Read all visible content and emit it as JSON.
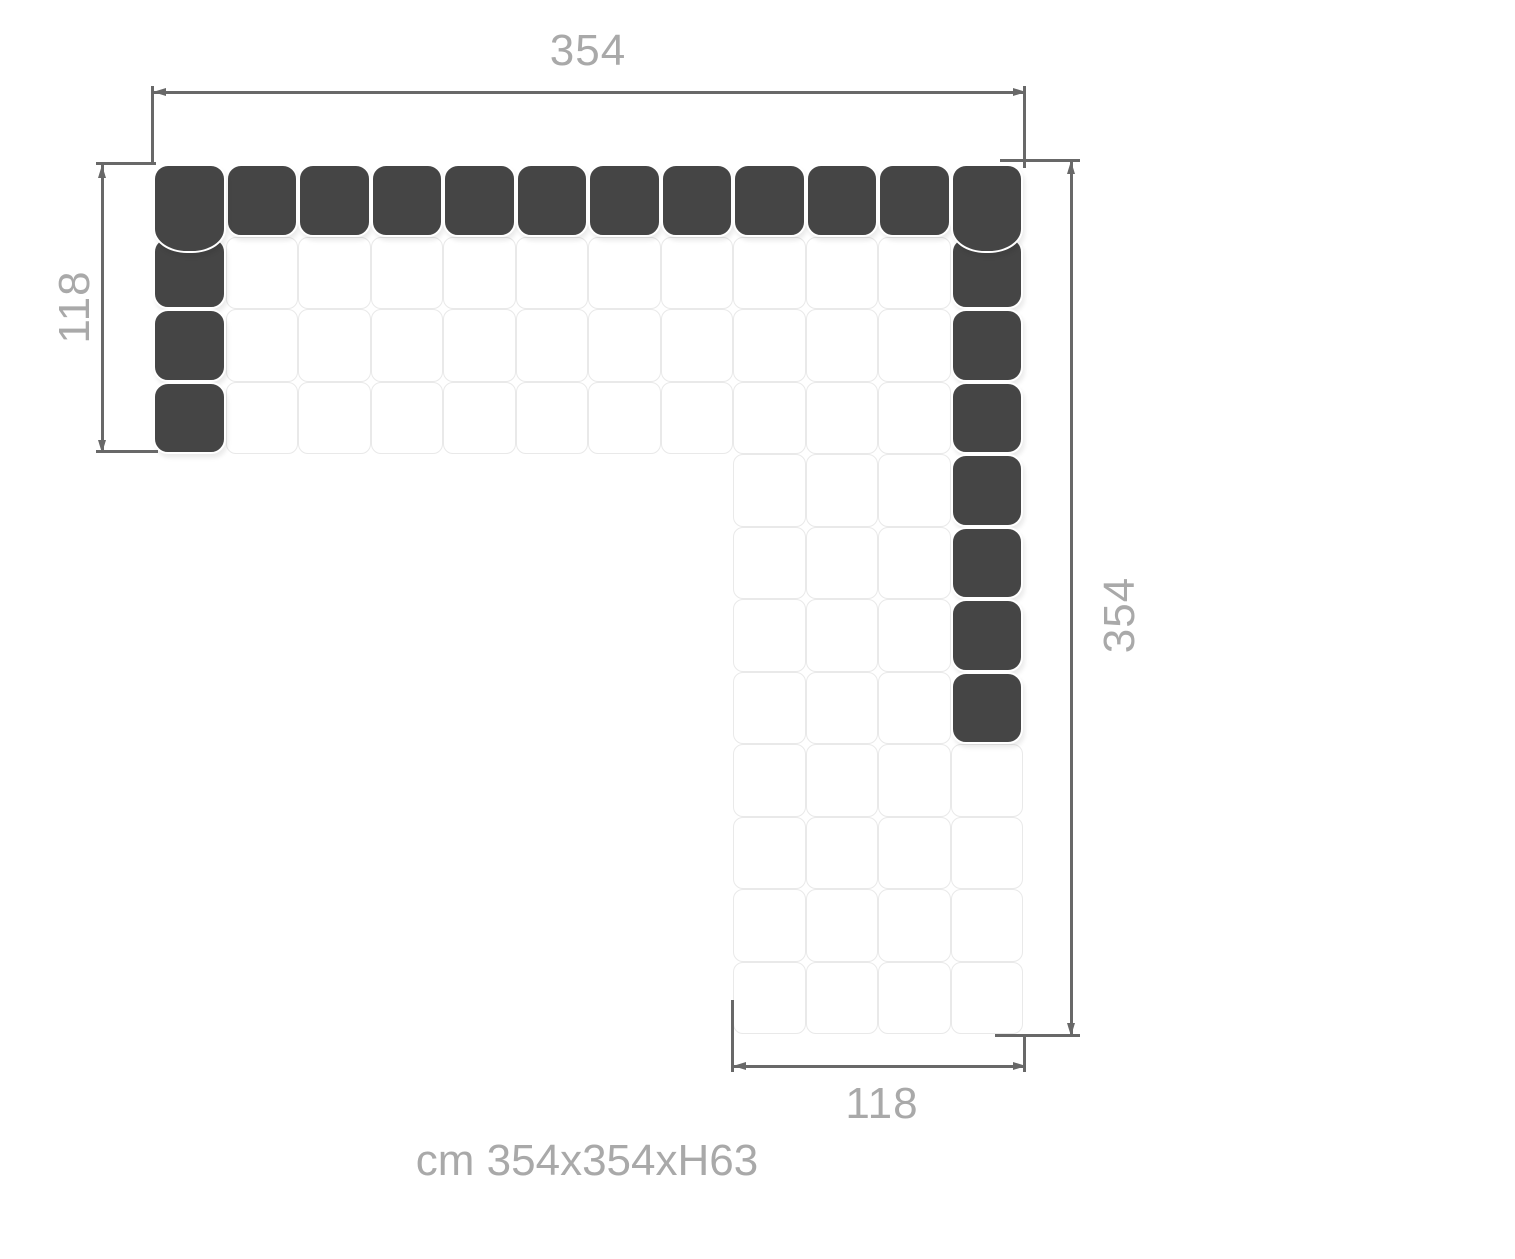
{
  "diagram": {
    "caption": "cm 354x354xH63",
    "dimension_labels": {
      "top": "354",
      "left": "118",
      "right": "354",
      "bottom": "118"
    },
    "unit": "cm",
    "overall_width_cm": 354,
    "overall_depth_cm": 354,
    "overall_height_cm": 63,
    "arm_depth_cm": 118
  },
  "sofa": {
    "type": "modular-corner-sofa-top-view",
    "grid": {
      "rows": 12,
      "cols": 12,
      "arm_rows": 4,
      "arm_cols": 4
    },
    "dark_modules": {
      "top_row": true,
      "left_column_rows": 3,
      "right_column_rows": 7
    }
  },
  "colors": {
    "cushion_dark": "#454545",
    "seat_border": "#e9e9e9",
    "dimension_line": "#686868",
    "label_text": "#a9a9a9",
    "background": "#ffffff"
  }
}
